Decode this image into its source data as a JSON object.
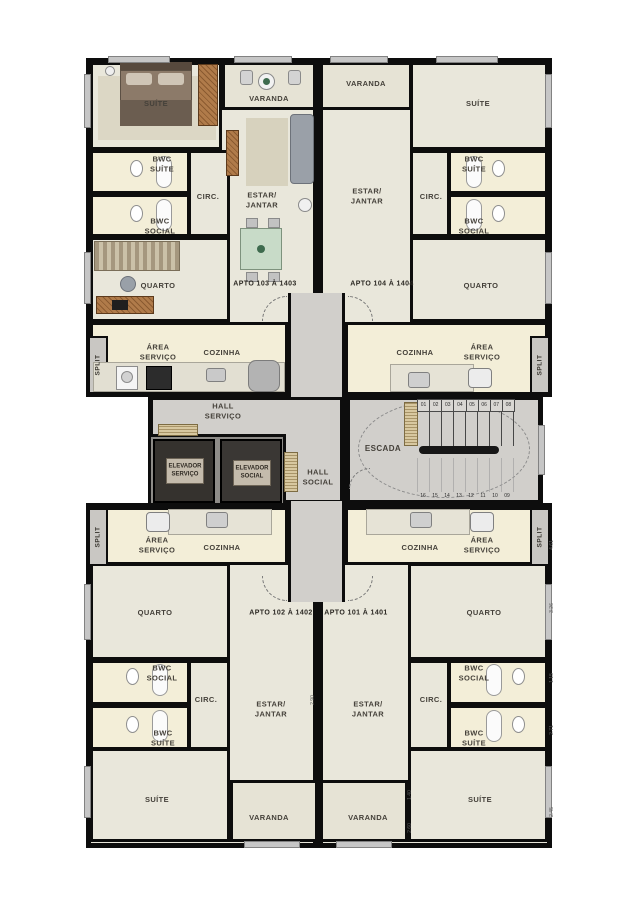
{
  "colors": {
    "wall": "#0d0d0d",
    "floor": "#e9e7db",
    "wet_floor": "#f3eed8",
    "hall_floor": "#d1cfcb",
    "wood": "#b07b4a",
    "elevator_box": "#35322e"
  },
  "rooms": {
    "suite": "SUÍTE",
    "varanda": "VARANDA",
    "bwc_suite": "BWC\nSUÍTE",
    "bwc_social": "BWC\nSOCIAL",
    "circ": "CIRC.",
    "estar": "ESTAR/\nJANTAR",
    "quarto": "QUARTO",
    "area": "ÁREA\nSERVIÇO",
    "cozinha": "COZINHA",
    "split": "SPLIT"
  },
  "apartments": {
    "a103": {
      "label": "APTO 103 À 1403"
    },
    "a104": {
      "label": "APTO 104 À 1404"
    },
    "a102": {
      "label": "APTO 102 À 1402"
    },
    "a101": {
      "label": "APTO 101 À 1401"
    }
  },
  "core": {
    "hall_servico": "HALL\nSERVIÇO",
    "hall_social": "HALL\nSOCIAL",
    "elev_servico": "ELEVADOR\nSERVIÇO",
    "elev_social": "ELEVADOR\nSOCIAL",
    "escada": "ESCADA",
    "steps_top": [
      "01",
      "02",
      "03",
      "04",
      "05",
      "06",
      "07",
      "08"
    ],
    "steps_bottom": [
      "16",
      "15",
      "14",
      "13",
      "12",
      "11",
      "10",
      "09"
    ]
  },
  "dims": {
    "d1": "4.61",
    "d2": "3.26",
    "d3": "1.15",
    "d4": "2.71",
    "d5": "2.45",
    "d6": "1.40",
    "d7": "2.60",
    "d8": "2.90"
  }
}
